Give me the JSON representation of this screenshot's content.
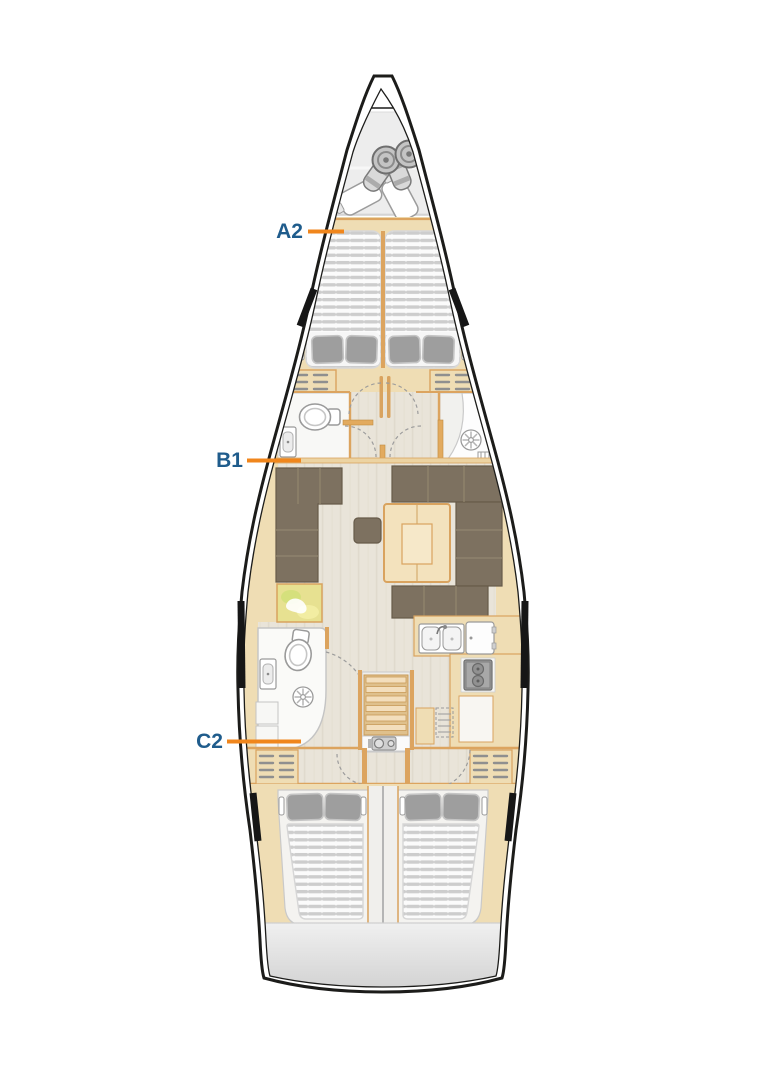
{
  "diagram": {
    "type": "sailing-yacht-interior-layout-plan",
    "labels": [
      {
        "text": "A2",
        "points_to": "forward-double-cabin"
      },
      {
        "text": "B1",
        "points_to": "forward-heads-compartment"
      },
      {
        "text": "C2",
        "points_to": "aft-port-double-cabin"
      }
    ],
    "colors": {
      "label_text": "#1f5c8c",
      "leader_line": "#f0861c",
      "hull_outline": "#1c1c1a",
      "wood_trim": "#d9a35f",
      "wood_fill": "#efddb4",
      "upholstery_brown": "#7d7160",
      "mattress_slat": "#cdcdcd",
      "pillow_gray": "#9e9e9e",
      "floor_plank": "#e9e4d9",
      "bow_locker_gray": "#ededed",
      "transom_gray": "#d7d7d7",
      "fixture_stroke": "#9a9a9a"
    }
  }
}
